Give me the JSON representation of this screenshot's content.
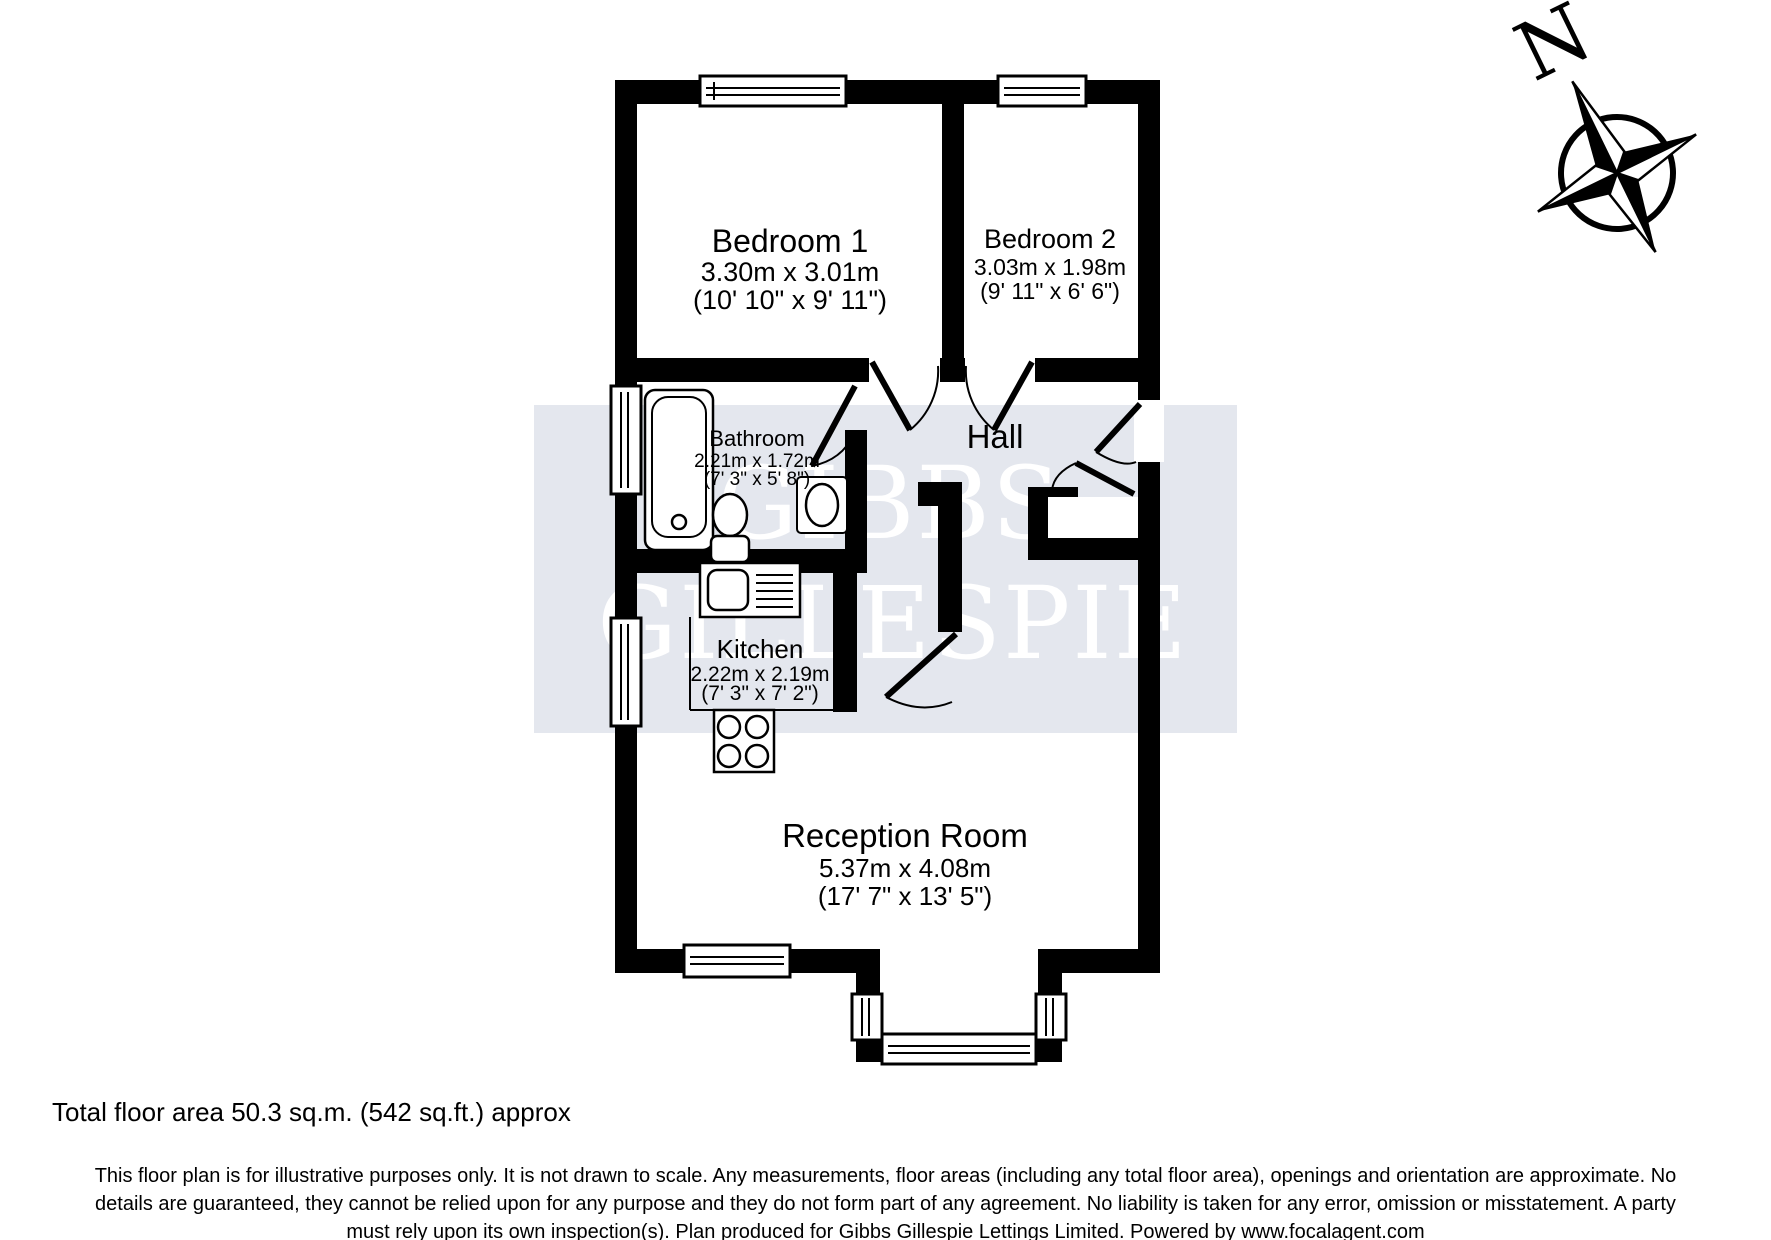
{
  "watermark": {
    "line1": "GIBBS",
    "line2": "GILLESPIE"
  },
  "compass": {
    "north_label": "N"
  },
  "rooms": {
    "bedroom1": {
      "name": "Bedroom 1",
      "size_metric": "3.30m x 3.01m",
      "size_imperial": "(10' 10\" x 9' 11\")"
    },
    "bedroom2": {
      "name": "Bedroom 2",
      "size_metric": "3.03m x 1.98m",
      "size_imperial": "(9' 11\" x 6' 6\")"
    },
    "bathroom": {
      "name": "Bathroom",
      "size_metric": "2.21m x 1.72m",
      "size_imperial": "(7' 3\" x 5' 8\")"
    },
    "hall": {
      "name": "Hall"
    },
    "kitchen": {
      "name": "Kitchen",
      "size_metric": "2.22m x 2.19m",
      "size_imperial": "(7' 3\" x 7' 2\")"
    },
    "reception": {
      "name": "Reception Room",
      "size_metric": "5.37m x 4.08m",
      "size_imperial": "(17' 7\" x 13' 5\")"
    }
  },
  "footer": {
    "total_area": "Total floor area 50.3 sq.m. (542 sq.ft.) approx",
    "disclaimer_line1": "This floor plan is for illustrative purposes only. It is not drawn to scale. Any measurements, floor areas (including any total floor area), openings and orientation are approximate. No",
    "disclaimer_line2": "details are guaranteed, they cannot be relied upon for any purpose and they do not form part of any agreement. No liability is taken for any error, omission or misstatement. A party",
    "disclaimer_line3": "must rely upon its own inspection(s). Plan produced for Gibbs Gillespie Lettings Limited. Powered by www.focalagent.com"
  },
  "colors": {
    "wall": "#000000",
    "watermark_band": "#e4e7ee",
    "watermark_text": "#ffffff"
  }
}
